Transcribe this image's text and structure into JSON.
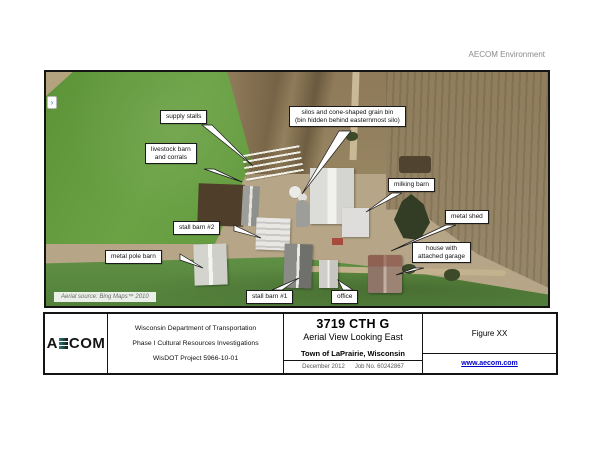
{
  "header": {
    "brand_text": "AECOM Environment"
  },
  "photo": {
    "source_note": "Aerial source: Bing Maps™ 2010",
    "marker_glyph": "›",
    "callouts": [
      {
        "lines": [
          "supply stalls"
        ]
      },
      {
        "lines": [
          "livestock barn",
          "and corrals"
        ]
      },
      {
        "lines": [
          "silos and cone-shaped grain bin",
          "(bin hidden behind easternmost silo)"
        ]
      },
      {
        "lines": [
          "milking barn"
        ]
      },
      {
        "lines": [
          "metal shed"
        ]
      },
      {
        "lines": [
          "stall barn #2"
        ]
      },
      {
        "lines": [
          "house with",
          "attached garage"
        ]
      },
      {
        "lines": [
          "metal pole barn"
        ]
      },
      {
        "lines": [
          "stall barn #1"
        ]
      },
      {
        "lines": [
          "office"
        ]
      }
    ]
  },
  "title_block": {
    "logo_a": "A",
    "logo_com": "COM",
    "agency_lines": [
      "Wisconsin Department of Transportation",
      "Phase I Cultural Resources Investigations",
      "WisDOT Project 5966-10-01"
    ],
    "title": "3719 CTH G",
    "subtitle": "Aerial View Looking East",
    "location": "Town of LaPrairie, Wisconsin",
    "date": "December 2012",
    "job_no": "Job No. 60242867",
    "figure_label": "Figure XX",
    "website": "www.aecom.com"
  },
  "colors": {
    "link_blue": "#0000cc",
    "field_green": "#66993f",
    "field_brown": "#8d7a5a",
    "farmyard_tan": "#b6a687",
    "pond_dark": "#333d25"
  }
}
